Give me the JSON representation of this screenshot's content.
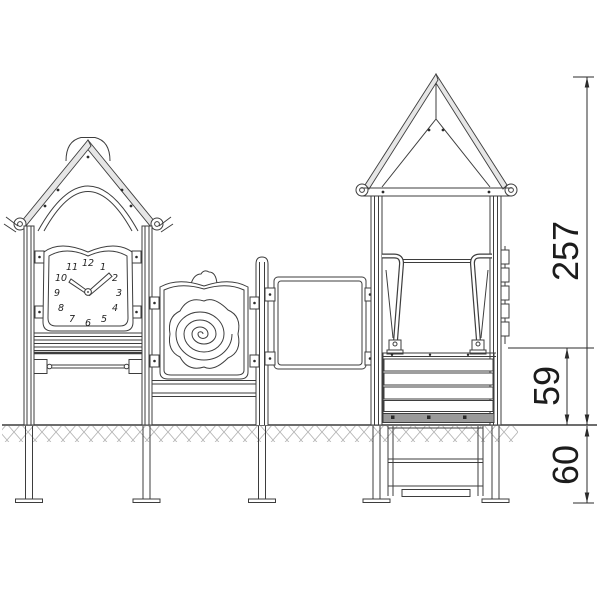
{
  "drawing": {
    "kind": "technical-elevation",
    "clock": {
      "numerals": [
        "12",
        "1",
        "2",
        "3",
        "4",
        "5",
        "6",
        "7",
        "8",
        "9",
        "10",
        "11"
      ]
    },
    "dimensions": {
      "total_height": "257",
      "platform_height": "59",
      "foundation_depth": "60"
    },
    "colors": {
      "line": "#3d3d3d",
      "roof_fill": "#e6e6e6",
      "deck_dark": "#9a9a9a",
      "hatch": "#b5b5b5",
      "dimension_text": "#1c1c1c",
      "background": "#ffffff"
    }
  }
}
